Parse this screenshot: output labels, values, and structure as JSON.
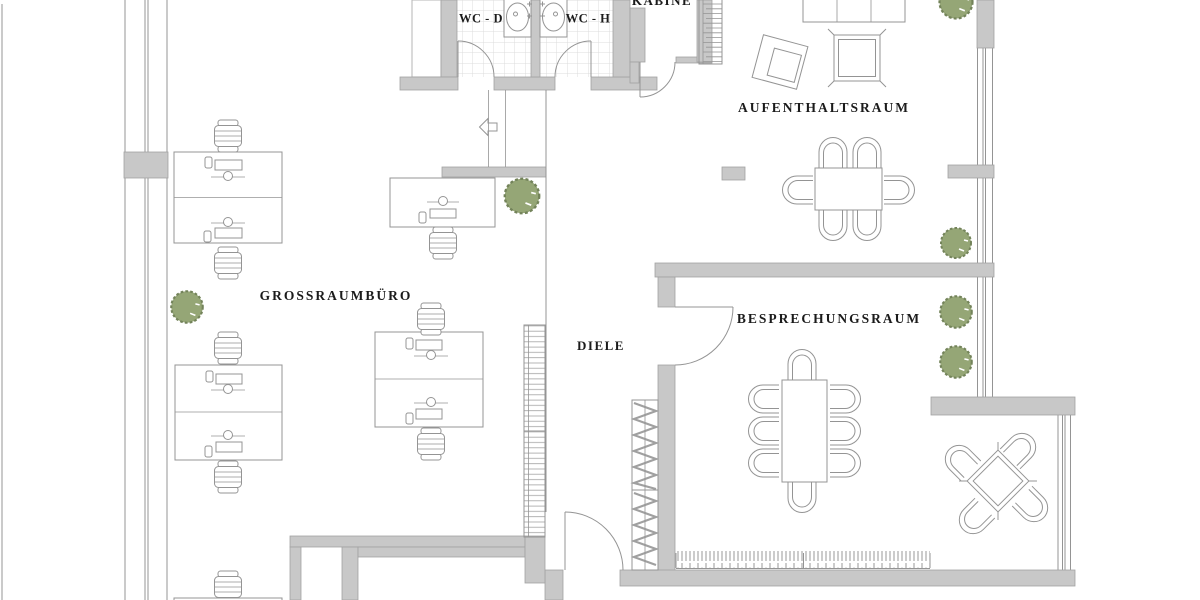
{
  "document": {
    "type": "architectural floor plan (office)",
    "language": "de"
  },
  "rooms": {
    "wc_d": {
      "label": "WC - D"
    },
    "wc_h": {
      "label": "WC - H"
    },
    "kabine": {
      "label": "KABINE"
    },
    "aufenthaltsraum": {
      "label": "AUFENTHALTSRAUM"
    },
    "grossraumbuero": {
      "label": "GROSSRAUMBÜRO"
    },
    "diele": {
      "label": "DIELE"
    },
    "besprechungsraum": {
      "label": "BESPRECHUNGSRAUM"
    }
  },
  "icons": {
    "entrance_direction": "arrow-left"
  },
  "colors": {
    "background": "#ffffff",
    "wall": "#c8c8c8",
    "wall_stroke": "#a2a2a2",
    "line": "#949494",
    "tile_line": "#dcdcdc",
    "plant_fill": "#95a676",
    "plant_stroke": "#73835a",
    "label_text": "#1b1b1b"
  },
  "furniture_inventory": [
    {
      "name": "double-desk-workstation",
      "count": 3
    },
    {
      "name": "single-desk-workstation",
      "count": 2
    },
    {
      "name": "office-chair",
      "count": 8
    },
    {
      "name": "dining-table-with-6-chairs",
      "count": 1
    },
    {
      "name": "conference-table-with-8-chairs",
      "count": 1
    },
    {
      "name": "square-table-with-4-chairs",
      "count": 1
    },
    {
      "name": "sofa",
      "count": 1
    },
    {
      "name": "armchair",
      "count": 1
    },
    {
      "name": "side-table",
      "count": 1
    },
    {
      "name": "plant",
      "count": 6
    },
    {
      "name": "washbasin",
      "count": 2
    },
    {
      "name": "wardrobe",
      "count": 1
    },
    {
      "name": "shelf",
      "count": 1
    },
    {
      "name": "radiator",
      "count": 2
    },
    {
      "name": "staircase",
      "count": 1
    }
  ]
}
